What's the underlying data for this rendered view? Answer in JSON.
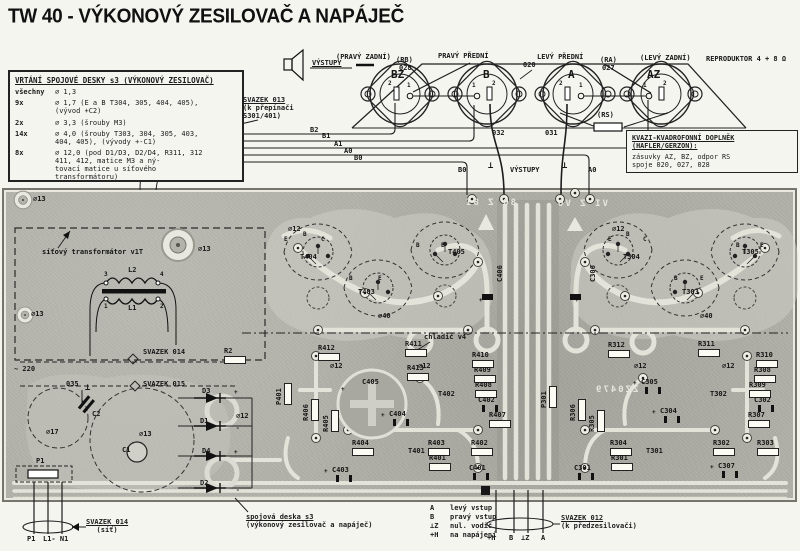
{
  "title": "TW 40 - VÝKONOVÝ ZESILOVAČ A NAPÁJEČ",
  "colors": {
    "board": "#b3b3ab",
    "trace": "#e3e3da",
    "ink": "#1b1b1b",
    "paper": "#f5f5f0"
  },
  "drill_table": {
    "title": "VRTÁNÍ SPOJOVÉ DESKY s3 (VÝKONOVÝ ZESILOVAČ)",
    "rows": [
      {
        "qty": "všechny",
        "spec": "∅ 1,3"
      },
      {
        "qty": "9x",
        "spec": "∅ 1,7 (E a B T304, 305, 404, 405),\n(vývod +C2)"
      },
      {
        "qty": "2x",
        "spec": "∅ 3,3 (šrouby M3)"
      },
      {
        "qty": "14x",
        "spec": "∅ 4,0 (šrouby T303, 304, 305, 403,\n404, 405), (vývody +-C1)"
      },
      {
        "qty": "8x",
        "spec": "∅ 12,0 (pod D1/D3, D2/D4, R311, 312\n411, 412, matice M3 a ný-\ntovací matice u síťového\ntransformátoru)"
      }
    ]
  },
  "svazek013": {
    "line1": "SVAZEK 013",
    "line2": "(k přepínači",
    "line3": "S301/401)"
  },
  "svazek014": {
    "line1": "SVAZEK 014",
    "line2": "(síť)"
  },
  "svazek012": {
    "line1": "SVAZEK 012",
    "line2": "(k předzesilovači)"
  },
  "board_label": {
    "line1": "spojová deska s3",
    "line2": "(výkonový zesilovač a napáječ)"
  },
  "kvazi": {
    "title1": "KVAZI-KVADROFONNÍ DOPLNĚK",
    "title2": "(HAFLER/GERZON):",
    "body1": "zásuvky AZ, BZ, odpor RS",
    "body2": "spoje 020, 027, 028"
  },
  "legend": [
    {
      "k": "A",
      "v": "levý vstup"
    },
    {
      "k": "B",
      "v": "pravý vstup"
    },
    {
      "k": "⊥Z",
      "v": "nul. vodič"
    },
    {
      "k": "+H",
      "v": "na napájení"
    }
  ],
  "labels": [
    {
      "t": "(PRAVÝ ZADNÍ)",
      "x": 336,
      "y": 54
    },
    {
      "t": "(RB)",
      "x": 396,
      "y": 57
    },
    {
      "t": "028",
      "x": 399,
      "y": 65
    },
    {
      "t": "PRAVÝ PŘEDNÍ",
      "x": 438,
      "y": 53
    },
    {
      "t": "LEVÝ PŘEDNÍ",
      "x": 537,
      "y": 54
    },
    {
      "t": "(RA)",
      "x": 600,
      "y": 57
    },
    {
      "t": "027",
      "x": 602,
      "y": 65
    },
    {
      "t": "(LEVÝ ZADNÍ)",
      "x": 640,
      "y": 55
    },
    {
      "t": "REPRODUKTOR 4 + 8 Ω",
      "x": 706,
      "y": 56
    },
    {
      "t": "VÝSTUPY",
      "x": 312,
      "y": 60,
      "s": "und"
    },
    {
      "t": "BZ",
      "x": 391,
      "y": 71,
      "s": "cname"
    },
    {
      "t": "B",
      "x": 483,
      "y": 71,
      "s": "cname"
    },
    {
      "t": "A",
      "x": 568,
      "y": 71,
      "s": "cname"
    },
    {
      "t": "AZ",
      "x": 647,
      "y": 71,
      "s": "cname"
    },
    {
      "t": "2",
      "x": 388,
      "y": 80,
      "s": "pin"
    },
    {
      "t": "1",
      "x": 407,
      "y": 82,
      "s": "pin"
    },
    {
      "t": "1",
      "x": 472,
      "y": 82,
      "s": "pin"
    },
    {
      "t": "2",
      "x": 492,
      "y": 80,
      "s": "pin"
    },
    {
      "t": "2",
      "x": 559,
      "y": 80,
      "s": "pin"
    },
    {
      "t": "1",
      "x": 579,
      "y": 82,
      "s": "pin"
    },
    {
      "t": "1",
      "x": 643,
      "y": 82,
      "s": "pin"
    },
    {
      "t": "2",
      "x": 663,
      "y": 80,
      "s": "pin"
    },
    {
      "t": "020",
      "x": 523,
      "y": 62
    },
    {
      "t": "(RS)",
      "x": 597,
      "y": 112
    },
    {
      "t": "032",
      "x": 492,
      "y": 130
    },
    {
      "t": "031",
      "x": 545,
      "y": 130
    },
    {
      "t": "B2",
      "x": 310,
      "y": 127
    },
    {
      "t": "B1",
      "x": 322,
      "y": 133
    },
    {
      "t": "A1",
      "x": 334,
      "y": 141
    },
    {
      "t": "A0",
      "x": 344,
      "y": 148
    },
    {
      "t": "B0",
      "x": 354,
      "y": 155
    },
    {
      "t": "B0",
      "x": 458,
      "y": 167
    },
    {
      "t": "⊥",
      "x": 488,
      "y": 163,
      "s": "gnd"
    },
    {
      "t": "VÝSTUPY",
      "x": 510,
      "y": 167
    },
    {
      "t": "⊥",
      "x": 562,
      "y": 163,
      "s": "gnd"
    },
    {
      "t": "A0",
      "x": 588,
      "y": 167
    },
    {
      "t": "∅13",
      "x": 33,
      "y": 196
    },
    {
      "t": "síťový transformátor v1T",
      "x": 42,
      "y": 249
    },
    {
      "t": "∅13",
      "x": 198,
      "y": 246
    },
    {
      "t": "∅13",
      "x": 31,
      "y": 311
    },
    {
      "t": "3",
      "x": 104,
      "y": 271,
      "s": "pin"
    },
    {
      "t": "L2",
      "x": 128,
      "y": 267
    },
    {
      "t": "4",
      "x": 160,
      "y": 271,
      "s": "pin"
    },
    {
      "t": "1",
      "x": 104,
      "y": 303,
      "s": "pin"
    },
    {
      "t": "L1",
      "x": 128,
      "y": 305
    },
    {
      "t": "2",
      "x": 160,
      "y": 303,
      "s": "pin"
    },
    {
      "t": "SVAZEK 014",
      "x": 143,
      "y": 349
    },
    {
      "t": "R2",
      "x": 224,
      "y": 348,
      "s": "res"
    },
    {
      "t": "~ 220",
      "x": 14,
      "y": 366
    },
    {
      "t": "SVAZEK 015",
      "x": 143,
      "y": 381
    },
    {
      "t": "035",
      "x": 66,
      "y": 381
    },
    {
      "t": "⊥",
      "x": 85,
      "y": 385,
      "s": "gnd"
    },
    {
      "t": "C2",
      "x": 92,
      "y": 411
    },
    {
      "t": "∅17",
      "x": 46,
      "y": 429
    },
    {
      "t": "∅13",
      "x": 139,
      "y": 431
    },
    {
      "t": "C1",
      "x": 122,
      "y": 447
    },
    {
      "t": "D3",
      "x": 202,
      "y": 388
    },
    {
      "t": "+",
      "x": 234,
      "y": 389,
      "s": "pin"
    },
    {
      "t": "∅12",
      "x": 236,
      "y": 413
    },
    {
      "t": "D1",
      "x": 200,
      "y": 418
    },
    {
      "t": "-",
      "x": 236,
      "y": 425,
      "s": "pin"
    },
    {
      "t": "D4",
      "x": 202,
      "y": 448
    },
    {
      "t": "+",
      "x": 234,
      "y": 449,
      "s": "pin"
    },
    {
      "t": "D2",
      "x": 200,
      "y": 480
    },
    {
      "t": "-",
      "x": 236,
      "y": 487,
      "s": "pin"
    },
    {
      "t": "P1",
      "x": 36,
      "y": 458
    },
    {
      "t": "∅12",
      "x": 288,
      "y": 226
    },
    {
      "t": "E",
      "x": 284,
      "y": 236,
      "s": "pin"
    },
    {
      "t": "B",
      "x": 303,
      "y": 231,
      "s": "pin"
    },
    {
      "t": "C",
      "x": 321,
      "y": 236,
      "s": "pin"
    },
    {
      "t": "T404",
      "x": 300,
      "y": 254
    },
    {
      "t": "B",
      "x": 349,
      "y": 275,
      "s": "pin"
    },
    {
      "t": "E",
      "x": 378,
      "y": 275,
      "s": "pin"
    },
    {
      "t": "T403",
      "x": 358,
      "y": 289
    },
    {
      "t": "B",
      "x": 416,
      "y": 242,
      "s": "pin"
    },
    {
      "t": "E",
      "x": 441,
      "y": 242,
      "s": "pin"
    },
    {
      "t": "T405",
      "x": 448,
      "y": 249
    },
    {
      "t": "∅40",
      "x": 378,
      "y": 313
    },
    {
      "t": "C406",
      "x": 497,
      "y": 282,
      "s": "vert"
    },
    {
      "t": "+",
      "x": 479,
      "y": 297,
      "s": "pin"
    },
    {
      "t": "chladič v4",
      "x": 424,
      "y": 334
    },
    {
      "t": "R412",
      "x": 318,
      "y": 345,
      "s": "res"
    },
    {
      "t": "∅12",
      "x": 330,
      "y": 363
    },
    {
      "t": "R411",
      "x": 405,
      "y": 341,
      "s": "res"
    },
    {
      "t": "∅12",
      "x": 418,
      "y": 363
    },
    {
      "t": "R413",
      "x": 407,
      "y": 365,
      "s": "res"
    },
    {
      "t": "R410",
      "x": 472,
      "y": 352,
      "s": "res"
    },
    {
      "t": "R409",
      "x": 474,
      "y": 367,
      "s": "res"
    },
    {
      "t": "R408",
      "x": 475,
      "y": 382,
      "s": "res"
    },
    {
      "t": "C402",
      "x": 478,
      "y": 397,
      "s": "cap"
    },
    {
      "t": "R407",
      "x": 489,
      "y": 412,
      "s": "res"
    },
    {
      "t": "C405",
      "x": 362,
      "y": 379
    },
    {
      "t": "+",
      "x": 341,
      "y": 386,
      "s": "pin"
    },
    {
      "t": "C404",
      "x": 389,
      "y": 411,
      "s": "cap"
    },
    {
      "t": "+",
      "x": 381,
      "y": 412,
      "s": "pin"
    },
    {
      "t": "P401",
      "x": 276,
      "y": 405,
      "s": "vert res"
    },
    {
      "t": "R406",
      "x": 303,
      "y": 421,
      "s": "vert res"
    },
    {
      "t": "R405",
      "x": 323,
      "y": 432,
      "s": "vert res"
    },
    {
      "t": "R404",
      "x": 352,
      "y": 440,
      "s": "res"
    },
    {
      "t": "C403",
      "x": 332,
      "y": 467,
      "s": "cap"
    },
    {
      "t": "+",
      "x": 324,
      "y": 468,
      "s": "pin"
    },
    {
      "t": "T402",
      "x": 438,
      "y": 391
    },
    {
      "t": "T401",
      "x": 408,
      "y": 448
    },
    {
      "t": "R403",
      "x": 428,
      "y": 440,
      "s": "res"
    },
    {
      "t": "R401",
      "x": 429,
      "y": 455,
      "s": "res"
    },
    {
      "t": "R402",
      "x": 471,
      "y": 440,
      "s": "res"
    },
    {
      "t": "C401",
      "x": 469,
      "y": 465,
      "s": "cap"
    },
    {
      "t": "∅12",
      "x": 612,
      "y": 226
    },
    {
      "t": "E",
      "x": 608,
      "y": 236,
      "s": "pin"
    },
    {
      "t": "B",
      "x": 626,
      "y": 231,
      "s": "pin"
    },
    {
      "t": "C",
      "x": 643,
      "y": 236,
      "s": "pin"
    },
    {
      "t": "T304",
      "x": 623,
      "y": 254
    },
    {
      "t": "B",
      "x": 674,
      "y": 275,
      "s": "pin"
    },
    {
      "t": "E",
      "x": 700,
      "y": 275,
      "s": "pin"
    },
    {
      "t": "T303",
      "x": 682,
      "y": 289
    },
    {
      "t": "B",
      "x": 736,
      "y": 242,
      "s": "pin"
    },
    {
      "t": "E",
      "x": 760,
      "y": 242,
      "s": "pin"
    },
    {
      "t": "T305",
      "x": 742,
      "y": 249
    },
    {
      "t": "∅40",
      "x": 700,
      "y": 313
    },
    {
      "t": "C306",
      "x": 590,
      "y": 282,
      "s": "vert"
    },
    {
      "t": "+",
      "x": 575,
      "y": 297,
      "s": "pin"
    },
    {
      "t": "R312",
      "x": 608,
      "y": 342,
      "s": "res"
    },
    {
      "t": "∅12",
      "x": 634,
      "y": 363
    },
    {
      "t": "R311",
      "x": 698,
      "y": 341,
      "s": "res"
    },
    {
      "t": "∅12",
      "x": 722,
      "y": 363
    },
    {
      "t": "R310",
      "x": 756,
      "y": 352,
      "s": "res"
    },
    {
      "t": "R308",
      "x": 754,
      "y": 367,
      "s": "res"
    },
    {
      "t": "R309",
      "x": 749,
      "y": 382,
      "s": "res"
    },
    {
      "t": "C302",
      "x": 754,
      "y": 397,
      "s": "cap"
    },
    {
      "t": "R307",
      "x": 748,
      "y": 412,
      "s": "res"
    },
    {
      "t": "C305",
      "x": 641,
      "y": 379,
      "s": "cap"
    },
    {
      "t": "+",
      "x": 633,
      "y": 380,
      "s": "pin"
    },
    {
      "t": "C304",
      "x": 660,
      "y": 408,
      "s": "cap"
    },
    {
      "t": "+",
      "x": 652,
      "y": 409,
      "s": "pin"
    },
    {
      "t": "T302",
      "x": 710,
      "y": 391
    },
    {
      "t": "P301",
      "x": 541,
      "y": 408,
      "s": "vert res"
    },
    {
      "t": "R306",
      "x": 570,
      "y": 421,
      "s": "vert res"
    },
    {
      "t": "R305",
      "x": 589,
      "y": 432,
      "s": "vert res"
    },
    {
      "t": "R304",
      "x": 610,
      "y": 440,
      "s": "res"
    },
    {
      "t": "R301",
      "x": 611,
      "y": 455,
      "s": "res"
    },
    {
      "t": "T301",
      "x": 646,
      "y": 448
    },
    {
      "t": "R302",
      "x": 713,
      "y": 440,
      "s": "res"
    },
    {
      "t": "R303",
      "x": 757,
      "y": 440,
      "s": "res"
    },
    {
      "t": "C301",
      "x": 574,
      "y": 465,
      "s": "cap"
    },
    {
      "t": "C307",
      "x": 718,
      "y": 463,
      "s": "cap"
    },
    {
      "t": "+",
      "x": 710,
      "y": 464,
      "s": "pin"
    },
    {
      "t": "8O Z 8I",
      "x": 464,
      "y": 200,
      "s": "mirror"
    },
    {
      "t": "VI Z VO",
      "x": 556,
      "y": 201,
      "s": "mirror"
    },
    {
      "t": "ZZ0479",
      "x": 594,
      "y": 387,
      "s": "mirror"
    },
    {
      "t": "P1",
      "x": 27,
      "y": 536
    },
    {
      "t": "L1- N1",
      "x": 43,
      "y": 536
    },
    {
      "t": "+H",
      "x": 487,
      "y": 535
    },
    {
      "t": "B",
      "x": 509,
      "y": 535
    },
    {
      "t": "⊥Z",
      "x": 521,
      "y": 535
    },
    {
      "t": "A",
      "x": 541,
      "y": 535
    }
  ]
}
